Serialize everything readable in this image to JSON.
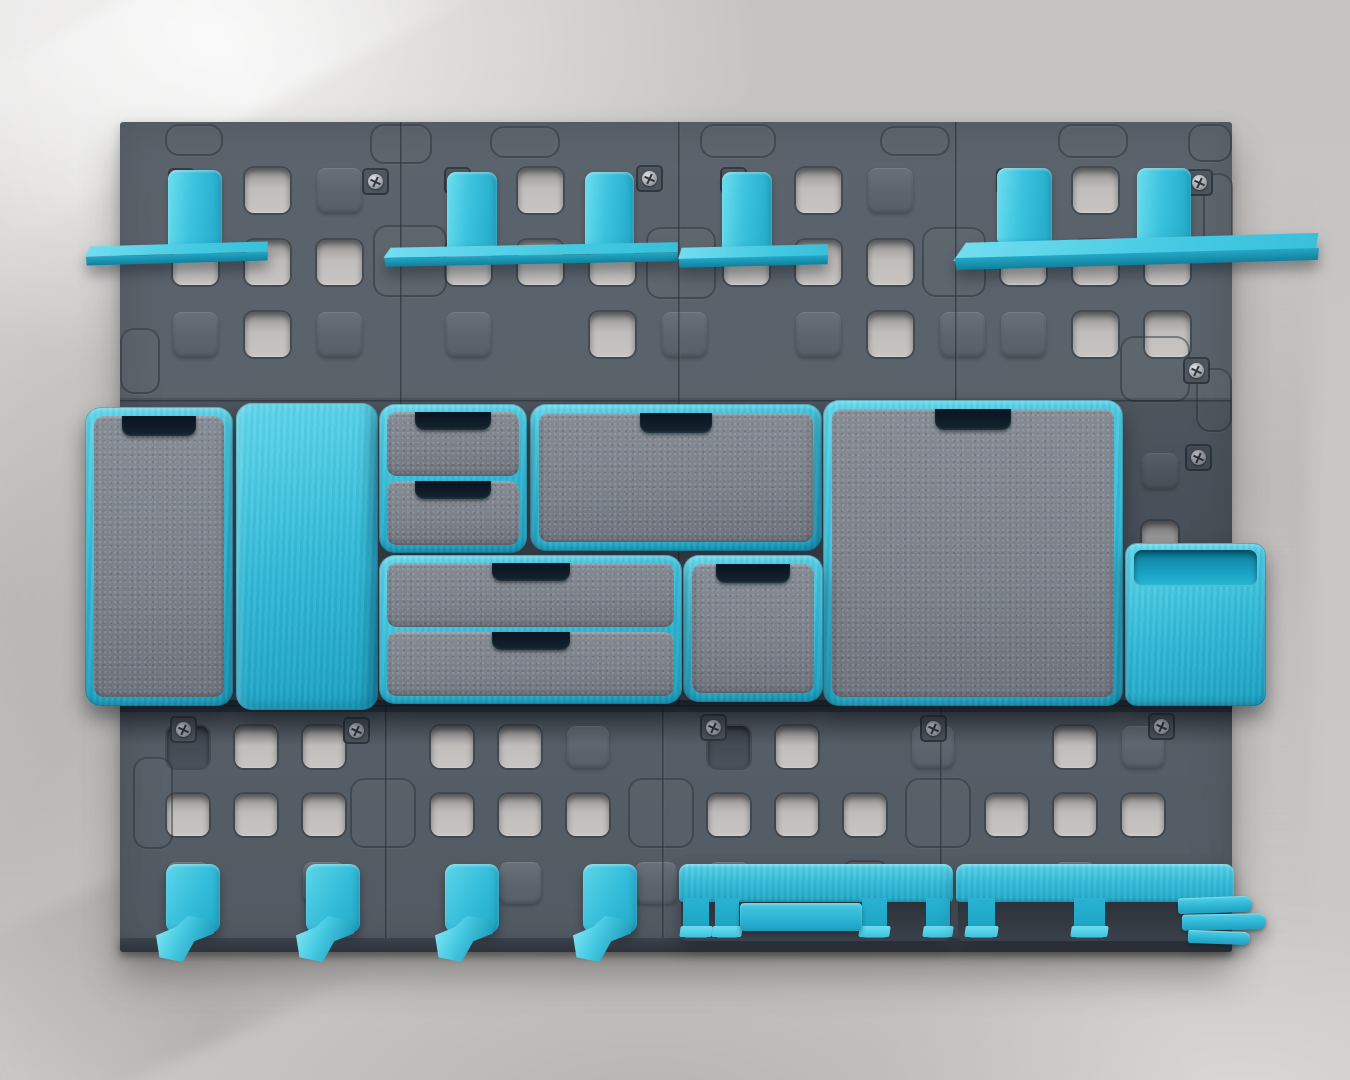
{
  "scene": {
    "type": "photograph",
    "description": "Overhead-style photo of a dark grey modular pegboard panel wall system mounted on a grey plaster wall, organised with turquoise plastic accessories: four shelves on top, a middle row of closed storage boxes and drawer units plus an open bin, and a bottom row of four single hooks and two multi-prong tool rails.",
    "palette": {
      "wall": "#cbc8c6",
      "wall_highlight": "#e3e2e1",
      "wall_shadow": "#b2afae",
      "panel": "#59616a",
      "panel_dark": "#454c55",
      "panel_edge": "#333a42",
      "hole_light": "#c7c4c2",
      "cyan": "#2fb8d6",
      "cyan_light": "#5fd7ec",
      "cyan_dark": "#1b9fc0",
      "cyan_deep": "#11809c",
      "front_gray": "#7b818a",
      "handle_dark": "#081320",
      "screw_metal": "#b5b9bd"
    },
    "inventory": {
      "panels": 12,
      "shelves": 4,
      "shelf_brackets": 6,
      "storage_boxes": 5,
      "drawer_units": 2,
      "drawers": 4,
      "open_bins": 1,
      "single_hooks": 4,
      "tool_rails": 2
    },
    "board": {
      "x": 120,
      "y": 122,
      "w": 1112,
      "h": 830
    },
    "pegboard": {
      "cells": [
        {
          "x": 127,
          "y": 122,
          "ox": 46,
          "oy": 46,
          "pitch": 72,
          "size": 45,
          "rows": [
            ".HB.",
            "HHH.",
            "BHB."
          ]
        },
        {
          "x": 400,
          "y": 122,
          "ox": 46,
          "oy": 46,
          "pitch": 72,
          "size": 45,
          "rows": [
            ".H..",
            "HHH.",
            "B.HB"
          ]
        },
        {
          "x": 678,
          "y": 122,
          "ox": 46,
          "oy": 46,
          "pitch": 72,
          "size": 45,
          "rows": [
            ".HB.",
            "HHH.",
            ".BHB"
          ]
        },
        {
          "x": 955,
          "y": 122,
          "ox": 46,
          "oy": 46,
          "pitch": 72,
          "size": 45,
          "rows": [
            ".H..",
            "HHH.",
            "BHH."
          ]
        },
        {
          "x": 955,
          "y": 400,
          "ox": 187,
          "oy": 53,
          "pitch": 68,
          "size": 36,
          "rows": [
            "B...",
            "H..."
          ]
        },
        {
          "x": 133,
          "y": 705,
          "ox": 34,
          "oy": 21,
          "pitch": 68,
          "size": 42,
          "rows": [
            "DHH.",
            "HHH.",
            "B.B."
          ]
        },
        {
          "x": 385,
          "y": 705,
          "ox": 46,
          "oy": 21,
          "pitch": 68,
          "size": 42,
          "rows": [
            "HHB.",
            "HHH.",
            ".B.B"
          ]
        },
        {
          "x": 662,
          "y": 705,
          "ox": 46,
          "oy": 21,
          "pitch": 68,
          "size": 42,
          "rows": [
            "DH.B",
            "HHH.",
            "B.H."
          ]
        },
        {
          "x": 940,
          "y": 705,
          "ox": 46,
          "oy": 21,
          "pitch": 68,
          "size": 42,
          "rows": [
            ".HB.",
            "HHH.",
            ".B.."
          ]
        }
      ],
      "connectors": [
        [
          373,
          225,
          74,
          72
        ],
        [
          646,
          227,
          70,
          72
        ],
        [
          922,
          227,
          64,
          70
        ],
        [
          1203,
          173,
          30,
          78
        ],
        [
          120,
          328,
          40,
          66
        ],
        [
          1120,
          336,
          70,
          66
        ],
        [
          1196,
          368,
          36,
          64
        ],
        [
          350,
          778,
          66,
          70
        ],
        [
          628,
          778,
          66,
          70
        ],
        [
          905,
          778,
          66,
          70
        ],
        [
          133,
          757,
          40,
          92
        ],
        [
          165,
          124,
          58,
          32
        ],
        [
          370,
          124,
          62,
          40
        ],
        [
          490,
          126,
          70,
          32
        ],
        [
          700,
          124,
          76,
          34
        ],
        [
          880,
          126,
          70,
          30
        ],
        [
          1058,
          124,
          70,
          34
        ],
        [
          1188,
          124,
          44,
          38
        ]
      ],
      "screws": [
        [
          168,
          168
        ],
        [
          362,
          168
        ],
        [
          444,
          167
        ],
        [
          636,
          165
        ],
        [
          720,
          167
        ],
        [
          996,
          168
        ],
        [
          1186,
          169
        ],
        [
          170,
          716
        ],
        [
          343,
          717
        ],
        [
          700,
          714
        ],
        [
          920,
          715
        ],
        [
          1148,
          713
        ],
        [
          1183,
          357
        ],
        [
          1185,
          444
        ]
      ],
      "seams_v": [
        [
          400,
          122,
          705
        ],
        [
          385,
          705,
          938
        ],
        [
          678,
          122,
          705
        ],
        [
          662,
          705,
          938
        ],
        [
          955,
          122,
          705
        ],
        [
          940,
          705,
          938
        ]
      ],
      "seams_h": [
        [
          400,
          120,
          1231
        ],
        [
          705,
          120,
          1231
        ]
      ]
    },
    "accessories": {
      "shelves": [
        {
          "id": "shelf-1",
          "plate": {
            "x": 85,
            "y": 244,
            "w": 183,
            "h": 19,
            "tilt": -1.6,
            "deep": false
          },
          "brackets": [
            {
              "x": 168,
              "y": 170,
              "w": 54,
              "h": 78
            }
          ]
        },
        {
          "id": "shelf-2",
          "plate": {
            "x": 383,
            "y": 245,
            "w": 295,
            "h": 19,
            "tilt": -1.1,
            "deep": false
          },
          "brackets": [
            {
              "x": 447,
              "y": 172,
              "w": 50,
              "h": 77
            },
            {
              "x": 585,
              "y": 172,
              "w": 49,
              "h": 77
            }
          ]
        },
        {
          "id": "shelf-3",
          "plate": {
            "x": 678,
            "y": 246,
            "w": 150,
            "h": 20,
            "tilt": -1.4,
            "deep": false
          },
          "brackets": [
            {
              "x": 722,
              "y": 172,
              "w": 50,
              "h": 78
            }
          ]
        },
        {
          "id": "shelf-4",
          "plate": {
            "x": 953,
            "y": 238,
            "w": 366,
            "h": 27,
            "tilt": -1.6,
            "deep": true
          },
          "brackets": [
            {
              "x": 997,
              "y": 168,
              "w": 55,
              "h": 74
            },
            {
              "x": 1137,
              "y": 168,
              "w": 54,
              "h": 74
            }
          ]
        }
      ],
      "boxes": [
        {
          "id": "storage-box-tall",
          "x": 85,
          "y": 407,
          "w": 148,
          "h": 299,
          "front": "gray",
          "handle": {
            "w": 74,
            "h": 20
          }
        },
        {
          "id": "storage-box-cyan",
          "x": 236,
          "y": 403,
          "w": 142,
          "h": 307,
          "front": "cyan",
          "handle": null
        },
        {
          "id": "storage-box-wide",
          "x": 530,
          "y": 404,
          "w": 292,
          "h": 147,
          "front": "gray",
          "handle": {
            "w": 72,
            "h": 20
          }
        },
        {
          "id": "storage-box-large",
          "x": 823,
          "y": 400,
          "w": 300,
          "h": 306,
          "front": "gray",
          "handle": {
            "w": 76,
            "h": 21
          }
        },
        {
          "id": "storage-box-small",
          "x": 683,
          "y": 555,
          "w": 140,
          "h": 147,
          "front": "gray",
          "handle": {
            "w": 74,
            "h": 19
          }
        }
      ],
      "drawer_units": [
        {
          "id": "drawer-unit-small",
          "x": 379,
          "y": 404,
          "w": 148,
          "h": 149,
          "count": 2,
          "handle_w": 76
        },
        {
          "id": "drawer-unit-wide",
          "x": 379,
          "y": 555,
          "w": 303,
          "h": 149,
          "count": 2,
          "handle_w": 78
        }
      ],
      "bin": {
        "id": "open-bin",
        "x": 1125,
        "y": 543,
        "w": 141,
        "h": 163
      },
      "hooks": [
        {
          "x": 166,
          "y": 864
        },
        {
          "x": 306,
          "y": 864
        },
        {
          "x": 445,
          "y": 864
        },
        {
          "x": 583,
          "y": 864
        }
      ],
      "rails": [
        {
          "id": "tool-rail-1",
          "x": 679,
          "y": 864,
          "w": 274,
          "prongs": [
            {
              "x": 4,
              "w": 26
            },
            {
              "x": 36,
              "w": 24
            },
            {
              "x": 183,
              "w": 25
            },
            {
              "x": 247,
              "w": 24
            }
          ],
          "slats": [
            {
              "x": 61,
              "y": 39,
              "w": 122,
              "h": 28
            }
          ],
          "fingers": []
        },
        {
          "id": "tool-rail-2",
          "x": 956,
          "y": 864,
          "w": 278,
          "prongs": [
            {
              "x": 12,
              "w": 27
            },
            {
              "x": 118,
              "w": 31
            }
          ],
          "slats": [],
          "fingers": [
            {
              "x": 222,
              "y": 33,
              "w": 74,
              "h": 16,
              "rot": -2
            },
            {
              "x": 226,
              "y": 50,
              "w": 84,
              "h": 16,
              "rot": -1
            },
            {
              "x": 232,
              "y": 67,
              "w": 62,
              "h": 13,
              "rot": 2
            }
          ]
        }
      ]
    }
  }
}
